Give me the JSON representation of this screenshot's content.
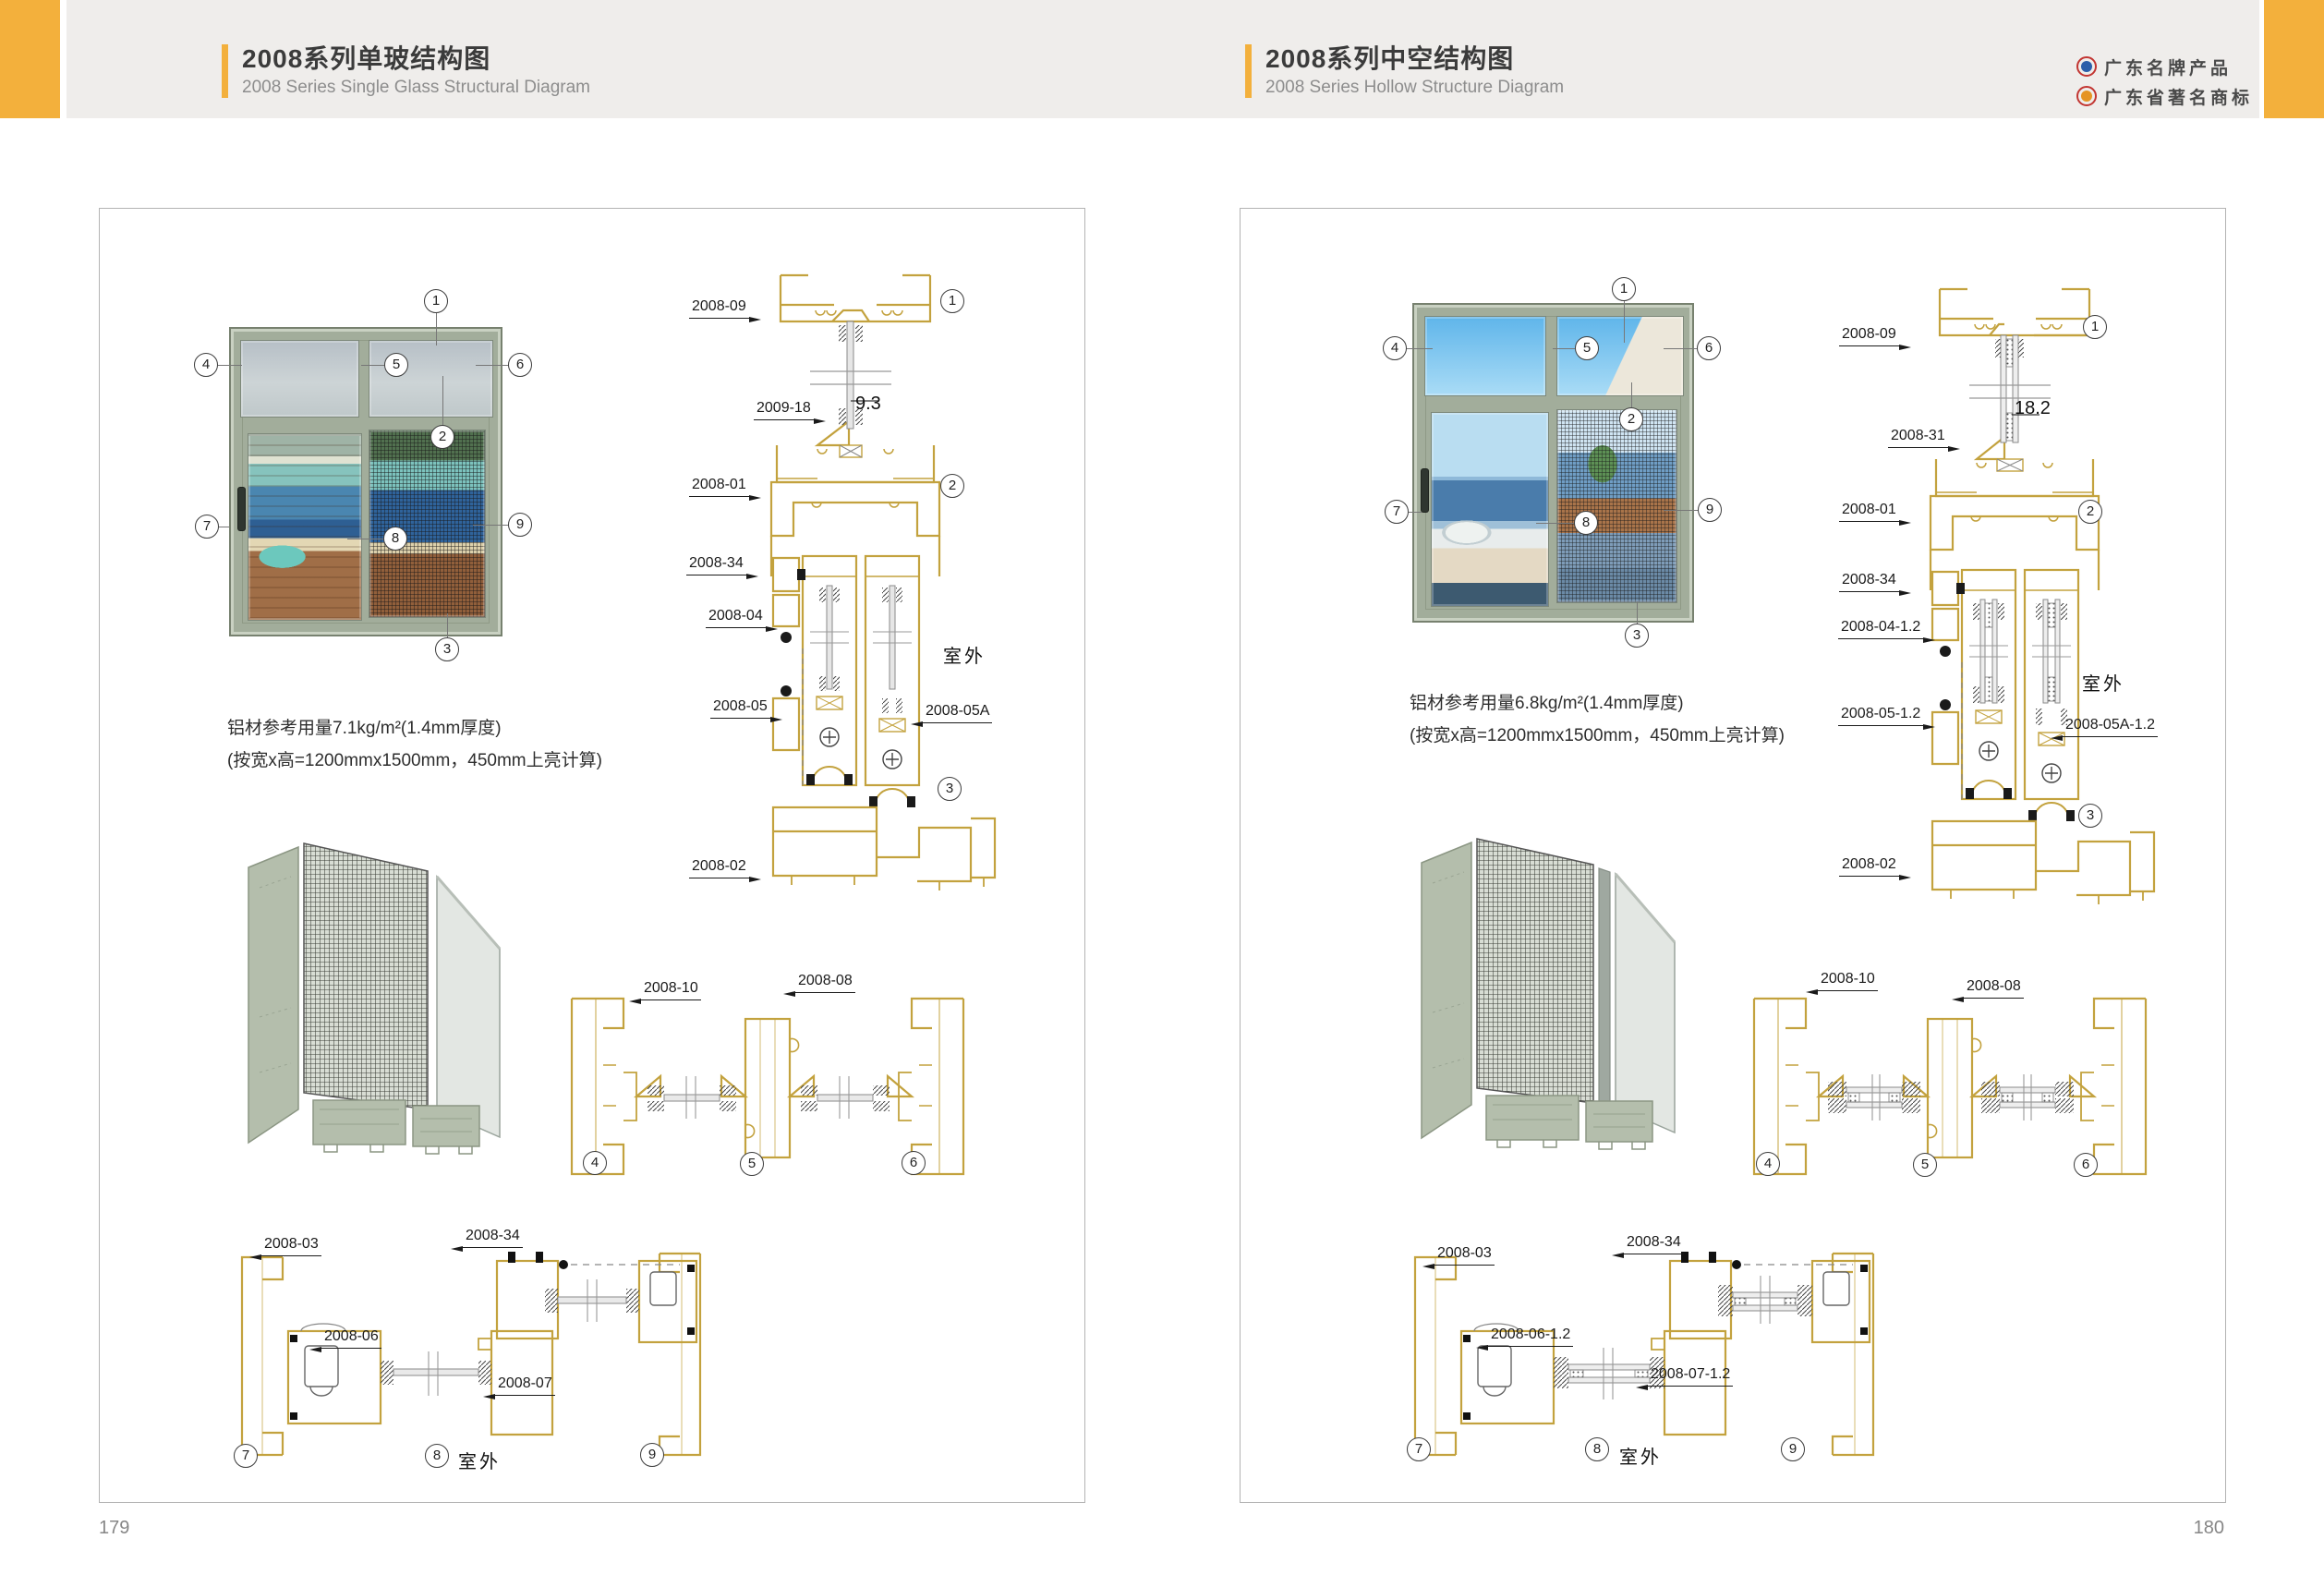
{
  "header": {
    "left_title": "2008系列单玻结构图",
    "left_subtitle": "2008 Series Single Glass Structural Diagram",
    "right_title": "2008系列中空结构图",
    "right_subtitle": "2008 Series Hollow Structure Diagram",
    "badge1": "广东名牌产品",
    "badge2": "广东省著名商标",
    "accent_color": "#F3B03C",
    "band_color": "#EFEDEB",
    "profile_line_color": "#C3A23E",
    "frame_color": "#A2AD9B"
  },
  "pages": {
    "left": {
      "page_number": "179",
      "usage": {
        "line1": "铝材参考用量7.1kg/m²(1.4mm厚度)",
        "line2": "(按宽x高=1200mmx1500mm，450mm上亮计算)"
      },
      "callouts": {
        "c1": "1",
        "c2": "2",
        "c3": "3",
        "c4": "4",
        "c5": "5",
        "c6": "6",
        "c7": "7",
        "c8": "8",
        "c9": "9"
      },
      "vsec": {
        "top_frame": "2008-09",
        "glazing_bead": "2009-18",
        "glass_dim": "9.3",
        "main_frame": "2008-01",
        "corner_block": "2008-34",
        "gasket_top": "2008-04",
        "outdoor": "室外",
        "gasket_bottom": "2008-05",
        "gasket_bottom_alt": "2008-05A",
        "bottom_track": "2008-02"
      },
      "msec": {
        "jamb": "2008-10",
        "interlock": "2008-08"
      },
      "bsec": {
        "jamb": "2008-03",
        "block": "2008-34",
        "stile_a": "2008-06",
        "stile_b": "2008-07",
        "outdoor": "室外"
      }
    },
    "right": {
      "page_number": "180",
      "usage": {
        "line1": "铝材参考用量6.8kg/m²(1.4mm厚度)",
        "line2": "(按宽x高=1200mmx1500mm，450mm上亮计算)"
      },
      "callouts": {
        "c1": "1",
        "c2": "2",
        "c3": "3",
        "c4": "4",
        "c5": "5",
        "c6": "6",
        "c7": "7",
        "c8": "8",
        "c9": "9"
      },
      "vsec": {
        "top_frame": "2008-09",
        "glazing_bead": "2008-31",
        "glass_dim": "18.2",
        "main_frame": "2008-01",
        "corner_block": "2008-34",
        "gasket_top": "2008-04-1.2",
        "outdoor": "室外",
        "gasket_bottom": "2008-05-1.2",
        "gasket_bottom_alt": "2008-05A-1.2",
        "bottom_track": "2008-02"
      },
      "msec": {
        "jamb": "2008-10",
        "interlock": "2008-08"
      },
      "bsec": {
        "jamb": "2008-03",
        "block": "2008-34",
        "stile_a": "2008-06-1.2",
        "stile_b": "2008-07-1.2",
        "outdoor": "室外"
      }
    }
  }
}
